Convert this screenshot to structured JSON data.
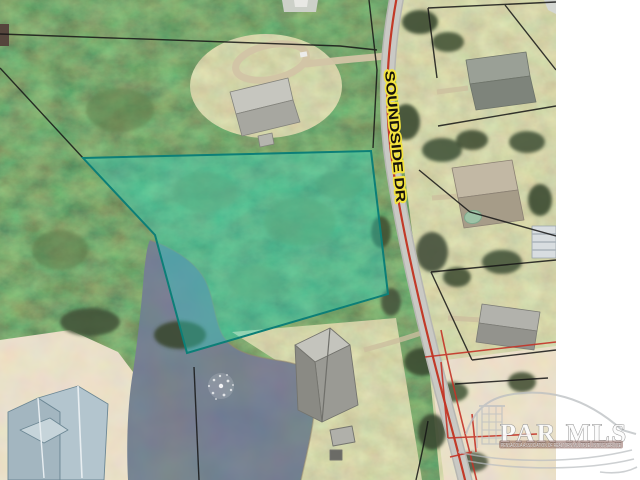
{
  "map": {
    "type": "aerial-parcel-map",
    "road": {
      "label": "SOUNDSIDE DR",
      "label_text_color": "#17130c",
      "label_halo_color": "#f2e33e",
      "surface_color": "#c9c9c4",
      "centerline_color": "#c23a28"
    },
    "parcel_highlight": {
      "fill": "#2bd6c5",
      "fill_opacity": "0.38",
      "border": "#0c7f77"
    },
    "boundary_line_color": "#161616",
    "red_line_color": "#c43327",
    "water_color": "#2e3846",
    "sand_color": "#d3c3a0"
  },
  "watermark": {
    "title": "PAR MLS",
    "tagline": "PENSACOLA ASSOCIATION OF REALTORS MULTIPLE LISTING SERVICE"
  }
}
